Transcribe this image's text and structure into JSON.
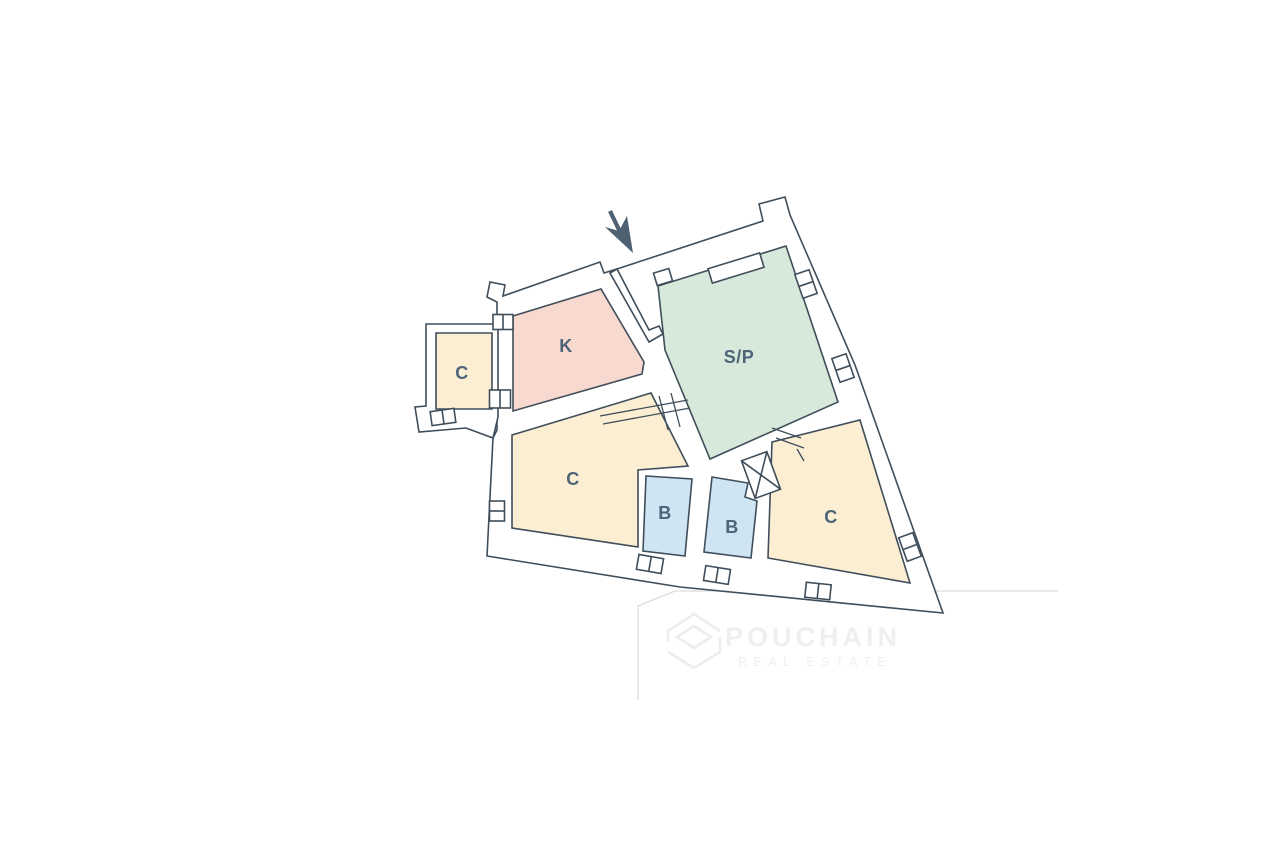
{
  "plan": {
    "wall_color": "#3f4e5a",
    "room_label_color": "#4e6478",
    "arrow_color": "#4e6173",
    "rooms": [
      {
        "id": "c-left",
        "label": "C",
        "color": "#fbeed3",
        "points": [
          [
            436,
            333
          ],
          [
            492,
            333
          ],
          [
            492,
            409
          ],
          [
            436,
            409
          ]
        ],
        "label_pos": [
          462,
          373
        ]
      },
      {
        "id": "k",
        "label": "K",
        "color": "#f8d9d0",
        "points": [
          [
            513,
            316
          ],
          [
            601,
            289
          ],
          [
            644,
            362
          ],
          [
            642,
            374
          ],
          [
            513,
            411
          ]
        ],
        "label_pos": [
          566,
          346
        ]
      },
      {
        "id": "sp",
        "label": "S/P",
        "color": "#d6e9da",
        "points": [
          [
            658,
            286
          ],
          [
            786,
            246
          ],
          [
            838,
            402
          ],
          [
            710,
            459
          ],
          [
            665,
            350
          ]
        ],
        "label_pos": [
          739,
          357
        ]
      },
      {
        "id": "c-center",
        "label": "C",
        "color": "#fbeed3",
        "points": [
          [
            512,
            435
          ],
          [
            651,
            393
          ],
          [
            688,
            466
          ],
          [
            638,
            470
          ],
          [
            638,
            547
          ],
          [
            512,
            528
          ]
        ],
        "label_pos": [
          573,
          479
        ]
      },
      {
        "id": "b-1",
        "label": "B",
        "color": "#cfe5f4",
        "points": [
          [
            646,
            476
          ],
          [
            692,
            479
          ],
          [
            685,
            556
          ],
          [
            643,
            551
          ]
        ],
        "label_pos": [
          665,
          513
        ]
      },
      {
        "id": "b-2",
        "label": "B",
        "color": "#cfe5f4",
        "points": [
          [
            712,
            477
          ],
          [
            748,
            483
          ],
          [
            745,
            497
          ],
          [
            757,
            501
          ],
          [
            751,
            558
          ],
          [
            704,
            552
          ]
        ],
        "label_pos": [
          732,
          527
        ]
      },
      {
        "id": "c-right",
        "label": "C",
        "color": "#fbeed3",
        "points": [
          [
            860,
            420
          ],
          [
            910,
            583
          ],
          [
            768,
            558
          ],
          [
            772,
            442
          ]
        ],
        "label_pos": [
          831,
          517
        ]
      }
    ]
  },
  "watermark": {
    "brand": "POUCHAIN",
    "tagline": "REAL ESTATE",
    "text_color": "#efefef",
    "logo_color": "#ededed",
    "boundary_color": "#dcdcdc"
  }
}
